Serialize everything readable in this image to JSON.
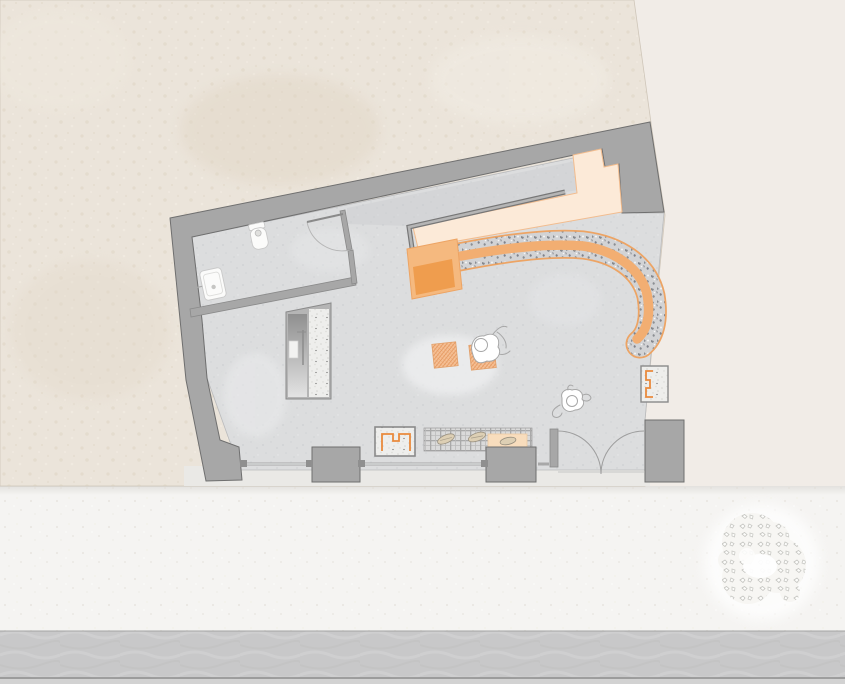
{
  "meta": {
    "drawing_type": "architectural floor plan, top-down view",
    "visible_text": "none",
    "style": "flat-color drafting with stipple and plaid textures, plan rotated slightly"
  },
  "colors": {
    "offwhite": "#f1ece7",
    "beige": "#ebe4da",
    "beige_speckle": "#ddd1c0",
    "sidewalk": "#f5f4f2",
    "sidewalk_speckle": "#eae7e2",
    "street": "#c8c8c9",
    "street_streak": "#d4d4d5",
    "curb": "#8e8e8e",
    "wall": "#a7a7a7",
    "wall_outline": "#6f6f6f",
    "floor": "#dcddde",
    "floor_speckle": "#cdcfd2",
    "counter": "#fcead8",
    "counter_edge": "#f2bc8e",
    "bar_rim": "#eda464",
    "bar_core": "#f2ae72",
    "bar_block": "#f5b97f",
    "bar_block_solid": "#ef9d4e",
    "accent": "#e98a3c",
    "terrazzo_base": "#d2d3d5",
    "terrazzo_chip": "#85888d",
    "plaid_base": "#dadada",
    "plaid_line": "#a9a9a9",
    "stipple_base": "#eeeeec",
    "stipple_dot": "#d6d6d2",
    "hatch_base": "#f5c096",
    "hatch_line": "#e19057",
    "fixture_fill": "#fbfbfa",
    "tree_leaf": "#c3c3bf",
    "tree_halo": "#ffffff"
  },
  "elements": {
    "site": [
      "neighbor-building",
      "surroundings",
      "sidewalk",
      "street",
      "street-tree"
    ],
    "shell": [
      "perimeter-wall",
      "window-piers",
      "storefront-windows",
      "double-entry-door"
    ],
    "wc_room": [
      "wc-partition-wall",
      "wc-door",
      "toilet",
      "washbasin"
    ],
    "core": [
      "stair-shaft"
    ],
    "bar_area": [
      "back-counter",
      "counter-screen",
      "curved-terrazzo-bar",
      "bar-service-block"
    ],
    "furniture": [
      "side-table-1",
      "side-table-2",
      "display-plinth",
      "retail-counter",
      "display-case",
      "bench-right"
    ],
    "people": [
      "seated-person",
      "walking-person"
    ]
  }
}
